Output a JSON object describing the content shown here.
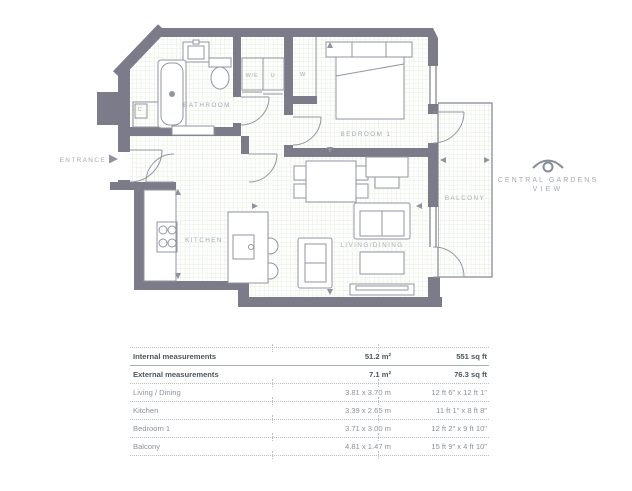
{
  "plan": {
    "labels": {
      "bathroom": "BATHROOM",
      "bedroom": "BEDROOM 1",
      "kitchen": "KITCHEN",
      "living": "LIVING/DINING",
      "balcony": "BALCONY",
      "entrance": "ENTRANCE",
      "closet_we": "W/E",
      "closet_u": "U",
      "wardrobe": "W",
      "closet_c": "C"
    },
    "colors": {
      "wall": "#7b7b8a",
      "floor_grid": "#e8eedd",
      "fixture_line": "#9096a2",
      "label_text": "#a5aab1"
    }
  },
  "logo": {
    "line1": "CENTRAL GARDENS",
    "line2": "VIEW"
  },
  "table": {
    "rows": [
      {
        "label": "Internal measurements",
        "metric": "51.2 m²",
        "imperial": "551 sq ft"
      },
      {
        "label": "External measurements",
        "metric": "7.1 m²",
        "imperial": "76.3 sq ft"
      },
      {
        "label": "Living / Dining",
        "metric": "3.81 x 3.70 m",
        "imperial": "12 ft 6\" x 12 ft 1\""
      },
      {
        "label": "Kitchen",
        "metric": "3.39 x 2.65 m",
        "imperial": "11 ft 1\" x 8 ft 8\""
      },
      {
        "label": "Bedroom 1",
        "metric": "3.71 x 3.00 m",
        "imperial": "12 ft 2\" x 9 ft 10\""
      },
      {
        "label": "Balcony",
        "metric": "4.81 x 1.47 m",
        "imperial": "15 ft 9\" x 4 ft 10\""
      }
    ]
  }
}
